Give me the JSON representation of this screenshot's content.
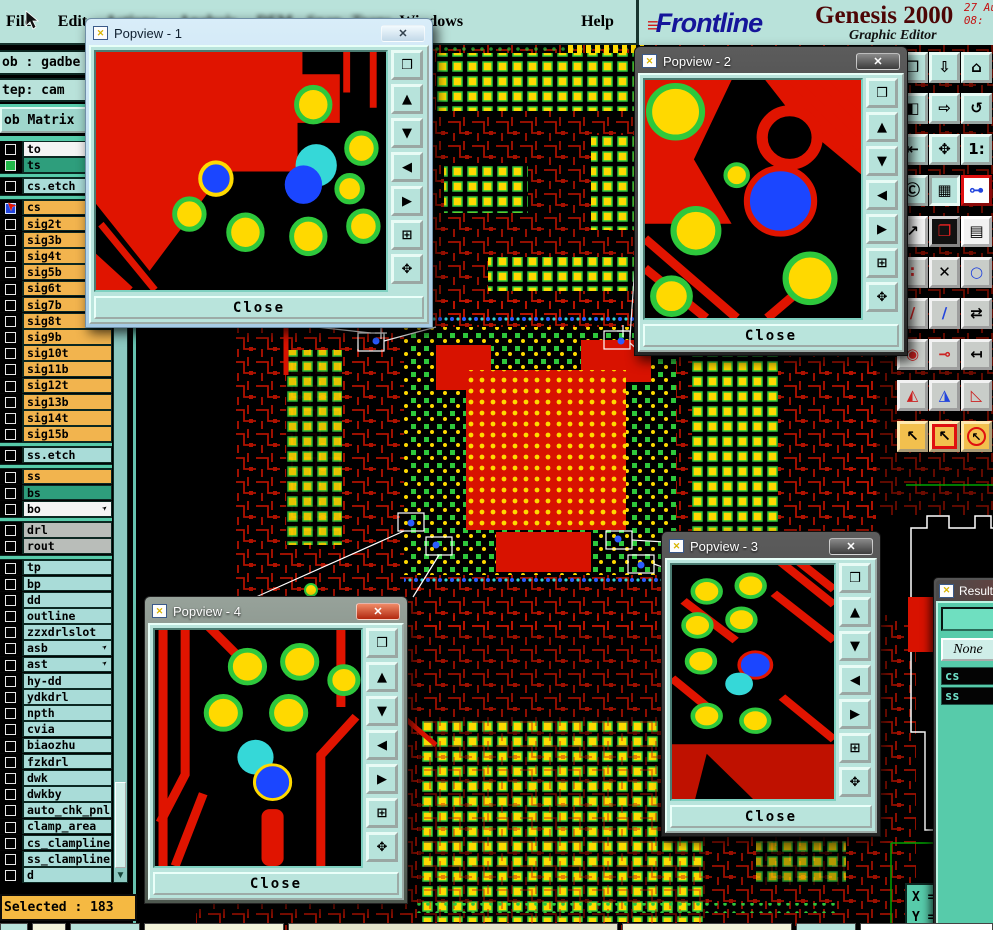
{
  "menu_bar": {
    "items": [
      {
        "label": "File",
        "blur": false
      },
      {
        "label": "Edit",
        "blur": false
      },
      {
        "label": "Actions",
        "blur": true
      },
      {
        "label": "Analysis",
        "blur": true
      },
      {
        "label": "DFM",
        "blur": true
      },
      {
        "label": "Snap",
        "blur": true
      },
      {
        "label": "Trans",
        "blur": true
      },
      {
        "label": "Windows",
        "blur": false
      },
      {
        "label": "Help",
        "blur": false
      }
    ]
  },
  "brand": {
    "speed_marks": "≡",
    "logo": "Frontline",
    "product": "Genesis 2000",
    "subtitle": "Graphic Editor",
    "date_line": "27 Au",
    "time_line": "08:"
  },
  "sidebar": {
    "job_label": "ob : gadbe",
    "step_label": "tep: cam",
    "matrix_button": "ob Matrix",
    "selected_label": "Selected : 183",
    "flag_glyph": "➤",
    "layers": [
      {
        "name": "to",
        "color": "white"
      },
      {
        "name": "ts",
        "color": "green",
        "box": "green"
      },
      {
        "sep": true
      },
      {
        "name": "cs.etch",
        "color": "cyan"
      },
      {
        "sep": true
      },
      {
        "name": "cs",
        "color": "orange",
        "box": "blue",
        "cursor": true
      },
      {
        "name": "sig2t",
        "color": "orange"
      },
      {
        "name": "sig3b",
        "color": "orange"
      },
      {
        "name": "sig4t",
        "color": "orange"
      },
      {
        "name": "sig5b",
        "color": "orange"
      },
      {
        "name": "sig6t",
        "color": "orange"
      },
      {
        "name": "sig7b",
        "color": "orange"
      },
      {
        "name": "sig8t",
        "color": "orange"
      },
      {
        "name": "sig9b",
        "color": "orange"
      },
      {
        "name": "sig10t",
        "color": "orange"
      },
      {
        "name": "sig11b",
        "color": "orange"
      },
      {
        "name": "sig12t",
        "color": "orange"
      },
      {
        "name": "sig13b",
        "color": "orange"
      },
      {
        "name": "sig14t",
        "color": "orange"
      },
      {
        "name": "sig15b",
        "color": "orange"
      },
      {
        "sep": true
      },
      {
        "name": "ss.etch",
        "color": "cyan"
      },
      {
        "sep": true
      },
      {
        "name": "ss",
        "color": "orange"
      },
      {
        "name": "bs",
        "color": "green"
      },
      {
        "name": "bo",
        "color": "white",
        "flag": true
      },
      {
        "sep": true
      },
      {
        "name": "drl",
        "color": "gray"
      },
      {
        "name": "rout",
        "color": "gray"
      },
      {
        "sep": true
      },
      {
        "name": "tp",
        "color": "cyan"
      },
      {
        "name": "bp",
        "color": "cyan"
      },
      {
        "name": "dd",
        "color": "cyan"
      },
      {
        "name": "outline",
        "color": "cyan"
      },
      {
        "name": "zzxdrlslot",
        "color": "cyan"
      },
      {
        "name": "asb",
        "color": "cyan",
        "flag": true
      },
      {
        "name": "ast",
        "color": "cyan",
        "flag": true
      },
      {
        "name": "hy-dd",
        "color": "cyan"
      },
      {
        "name": "ydkdrl",
        "color": "cyan"
      },
      {
        "name": "npth",
        "color": "cyan"
      },
      {
        "name": "cvia",
        "color": "cyan"
      },
      {
        "name": "biaozhu",
        "color": "cyan"
      },
      {
        "name": "fzkdrl",
        "color": "cyan"
      },
      {
        "name": "dwk",
        "color": "cyan"
      },
      {
        "name": "dwkby",
        "color": "cyan"
      },
      {
        "name": "auto_chk_pnl",
        "color": "cyan"
      },
      {
        "name": "clamp_area",
        "color": "cyan"
      },
      {
        "name": "cs_clampline",
        "color": "cyan"
      },
      {
        "name": "ss_clampline",
        "color": "cyan"
      },
      {
        "name": "d",
        "color": "cyan"
      },
      {
        "name": "0",
        "color": "cyan"
      },
      {
        "name": "1",
        "color": "cyan"
      }
    ]
  },
  "popviews": [
    {
      "title": "Popview - 1",
      "close_label": "Close"
    },
    {
      "title": "Popview - 2",
      "close_label": "Close"
    },
    {
      "title": "Popview - 3",
      "close_label": "Close"
    },
    {
      "title": "Popview - 4",
      "close_label": "Close"
    }
  ],
  "popview_toolbar": {
    "buttons": [
      {
        "name": "new-popview-icon",
        "glyph": "❒"
      },
      {
        "name": "pan-up-icon",
        "glyph": "▲"
      },
      {
        "name": "pan-down-icon",
        "glyph": "▼"
      },
      {
        "name": "pan-left-icon",
        "glyph": "◀"
      },
      {
        "name": "pan-right-icon",
        "glyph": "▶"
      },
      {
        "name": "zoom-in-icon",
        "glyph": "⊞"
      },
      {
        "name": "zoom-fit-icon",
        "glyph": "✥"
      }
    ]
  },
  "right_toolbar": {
    "buttons": [
      {
        "name": "popview-button",
        "glyph": "❒",
        "bg": "teal"
      },
      {
        "name": "pan-window-down-button",
        "glyph": "⇩",
        "bg": "teal"
      },
      {
        "name": "home-view-button",
        "glyph": "⌂",
        "bg": "teal"
      },
      {
        "name": "window-left-button",
        "glyph": "◧",
        "bg": "teal"
      },
      {
        "name": "pan-window-right-button",
        "glyph": "⇨",
        "bg": "teal"
      },
      {
        "name": "rotate-view-button",
        "glyph": "↺",
        "bg": "teal"
      },
      {
        "name": "pan-edge-button",
        "glyph": "⇤",
        "bg": "teal"
      },
      {
        "name": "pan-center-button",
        "glyph": "✥",
        "bg": "teal"
      },
      {
        "name": "zoom-1-1-button",
        "glyph": "1:",
        "bg": "teal"
      },
      {
        "name": "cam-info-button",
        "glyph": "Ⓒ",
        "bg": "teal"
      },
      {
        "name": "grid-toggle-button",
        "glyph": "▦",
        "bg": "teal",
        "pressed": true
      },
      {
        "name": "net-compare-button",
        "glyph": "⊶",
        "bg": "teal",
        "fg": "#2244dd",
        "frame": "red-border"
      },
      {
        "name": "select-move-button",
        "glyph": "↗",
        "bg": "white"
      },
      {
        "name": "zoom-window-button",
        "glyph": "❐",
        "bg": "black",
        "fg": "#ee2222"
      },
      {
        "name": "ruler-button",
        "glyph": "▤",
        "bg": "white"
      },
      {
        "name": "pad-stack-button",
        "glyph": "∶",
        "bg": "gray",
        "fg": "#cc2222"
      },
      {
        "name": "delete-mode-button",
        "glyph": "✕",
        "bg": "gray"
      },
      {
        "name": "measure-point-button",
        "glyph": "○",
        "bg": "gray",
        "fg": "#2244dd"
      },
      {
        "name": "slope-line-red-button",
        "glyph": "∕",
        "bg": "gray",
        "fg": "#cc2222"
      },
      {
        "name": "slope-line-blue-button",
        "glyph": "∕",
        "bg": "gray",
        "fg": "#2244dd"
      },
      {
        "name": "swap-direction-button",
        "glyph": "⇄",
        "bg": "gray"
      },
      {
        "name": "circle-pad-button",
        "glyph": "◉",
        "bg": "gray",
        "fg": "#cc2222"
      },
      {
        "name": "segment-mid-button",
        "glyph": "⊸",
        "bg": "gray",
        "fg": "#cc2222"
      },
      {
        "name": "dimension-left-button",
        "glyph": "↤",
        "bg": "gray"
      },
      {
        "name": "angle-red-button",
        "glyph": "◭",
        "bg": "gray",
        "fg": "#cc2222"
      },
      {
        "name": "angle-blue-button",
        "glyph": "◮",
        "bg": "gray",
        "fg": "#2244dd"
      },
      {
        "name": "angle-half-button",
        "glyph": "◺",
        "bg": "gray",
        "fg": "#cc2222"
      },
      {
        "name": "cursor-select-button",
        "glyph": "↖",
        "bg": "yellow"
      },
      {
        "name": "cursor-select-box-button",
        "glyph": "↖",
        "bg": "yellow",
        "frame": "red-box"
      },
      {
        "name": "cursor-select-circle-button",
        "glyph": "↖",
        "bg": "yellow",
        "frame": "red-circle"
      }
    ]
  },
  "result_window": {
    "title": "Result",
    "none_button": "None",
    "items": [
      "cs",
      "ss"
    ]
  },
  "coords": {
    "x_label": "X =",
    "y_label": "Y ="
  }
}
